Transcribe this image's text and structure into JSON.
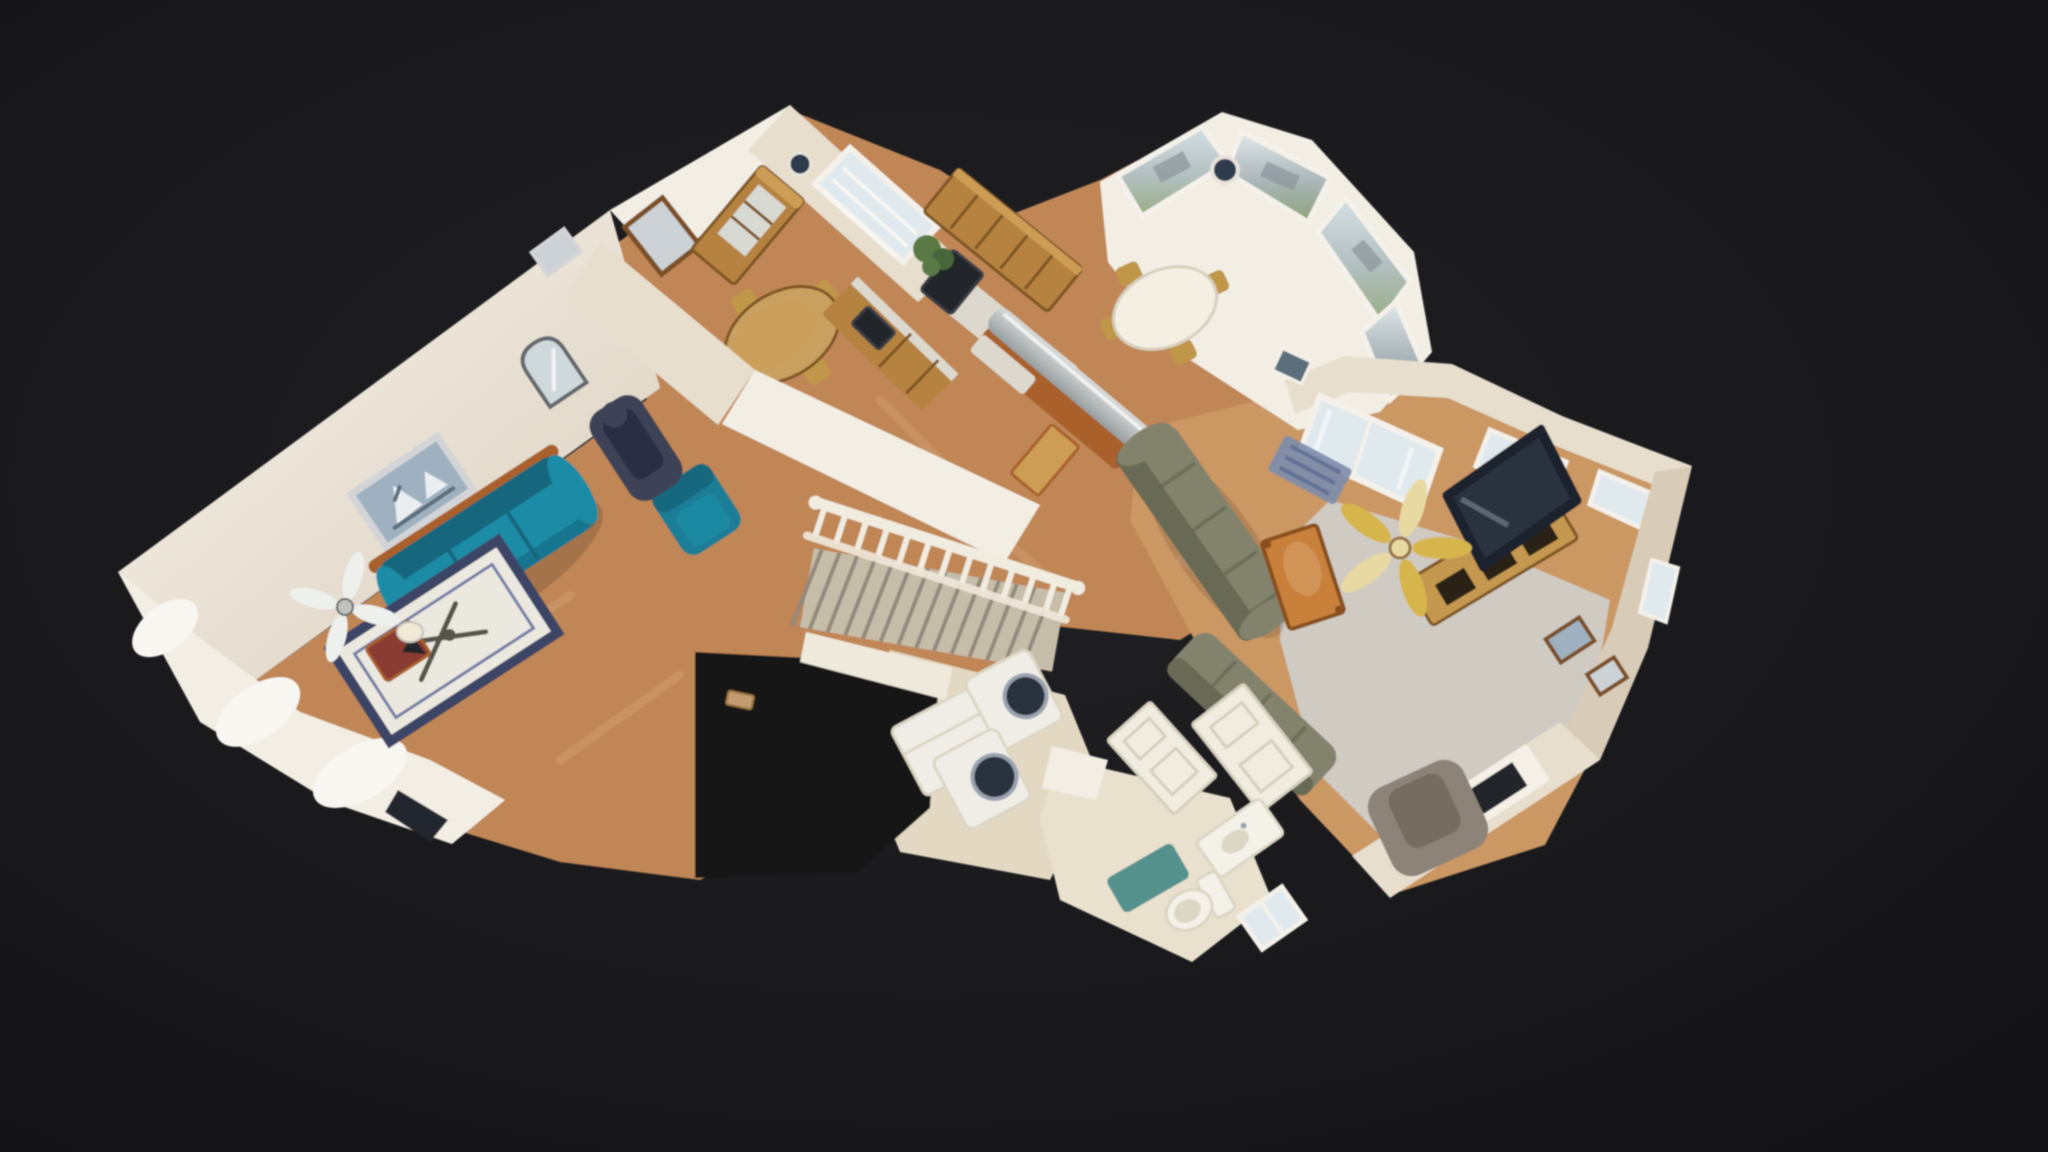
{
  "canvas": {
    "width": 2048,
    "height": 1152
  },
  "regions": [
    "formal-living-room",
    "hallway",
    "dining-room",
    "kitchen",
    "breakfast-nook",
    "family-room",
    "staircase",
    "laundry-room",
    "bathroom"
  ],
  "colors": {
    "bgCenter": "#212125",
    "bgEdge": "#141416",
    "void": "#131316",
    "wallTop": "#f7f3ea",
    "wallBot": "#d9cebd",
    "wallA": "#f3eee4",
    "wallB": "#e7decd",
    "wallC": "#d8ccb8",
    "woodA": "#c08656",
    "woodB": "#cb9764",
    "streak": "#e0b285",
    "carpet": "#cfcac2",
    "tile": "#e3d9c3",
    "tileBath": "#e9e1ce",
    "rail": "#f1ece0",
    "stepCarpet": "#c6bda9",
    "stepEdge": "#94897c",
    "stringer": "#efe9db",
    "tealSofa": "#1f8ba5",
    "tealSofaDark": "#14667e",
    "woodTrim": "#a9612a",
    "tealChair": "#1e7d96",
    "tealChairDark": "#16677e",
    "rugW": "#ebe8df",
    "rugB": "#3d4566",
    "rugLine": "#737da6",
    "stick": "#54544a",
    "massage": "#3e4257",
    "massageDark": "#2b2f42",
    "burgundy": "#8a3a30",
    "lamp": "#f0e9d4",
    "fanWhite": "#eef0ed",
    "fanHub": "#c2c2bd",
    "brass": "#d7b54e",
    "brassHub": "#e8d9a3",
    "artSky": "#9fb1c0",
    "artWhite": "#eaeef1",
    "artDark": "#5c6e7c",
    "silver": "#d3d4d7",
    "frameWood": "#7c4f28",
    "mirror": "#cfd8da",
    "mirrorRim": "#63676d",
    "picGray": "#ccd2d5",
    "oak": "#b5823f",
    "oakLight": "#cd9c55",
    "oakDark": "#7e5422",
    "counter": "#dcd8cd",
    "steelA": "#d8dbda",
    "steelB": "#989ea0",
    "black": "#23252c",
    "blackMid": "#3a3d46",
    "glass": "#dfe9ee",
    "frameWhite": "#f4f1ea",
    "blind": "#f8f7f3",
    "viewSkyA": "#d4dfe4",
    "viewMidA": "#b2bfc0",
    "viewGreenA": "#97ac82",
    "viewSkyB": "#e1e8eb",
    "viewMidB": "#a9b5b9",
    "viewGreenB": "#8da377",
    "viewHouse": "#8b949a",
    "clock": "#2e3a4e",
    "clockRing": "#e8e4da",
    "cloth": "#f4efe2",
    "chairGold": "#c0964a",
    "tableWood": "#c9a05f",
    "sect": "#83836d",
    "sectDark": "#696a55",
    "cTable": "#c8803a",
    "cTableEdge": "#8a4f1f",
    "console": "#c5984f",
    "consoleDark": "#2a2117",
    "tv": "#1b222e",
    "tvScreen": "#2b3544",
    "door": "#f1ece0",
    "doorLine": "#d6cfbd",
    "washer": "#efede6",
    "washerDoor": "#2b3140",
    "washerRing": "#9aa2af",
    "bathRug": "#4f8d89",
    "porcelain": "#f4f1e9",
    "porcelainSh": "#dcd6c5",
    "plant": "#5a7a44",
    "plantDark": "#47663a",
    "rugBlue": "#7e8cab",
    "rugBlueDark": "#5a6a92",
    "recliner": "#8d8378",
    "reclinerDark": "#766c61",
    "curtain": "#f8f6f1",
    "vent": "#c29a70",
    "ventDark": "#96713f",
    "darkWin": "#22262e",
    "fire": "#22252c",
    "mantel": "#f4f0e7",
    "shadow": "#000000"
  }
}
